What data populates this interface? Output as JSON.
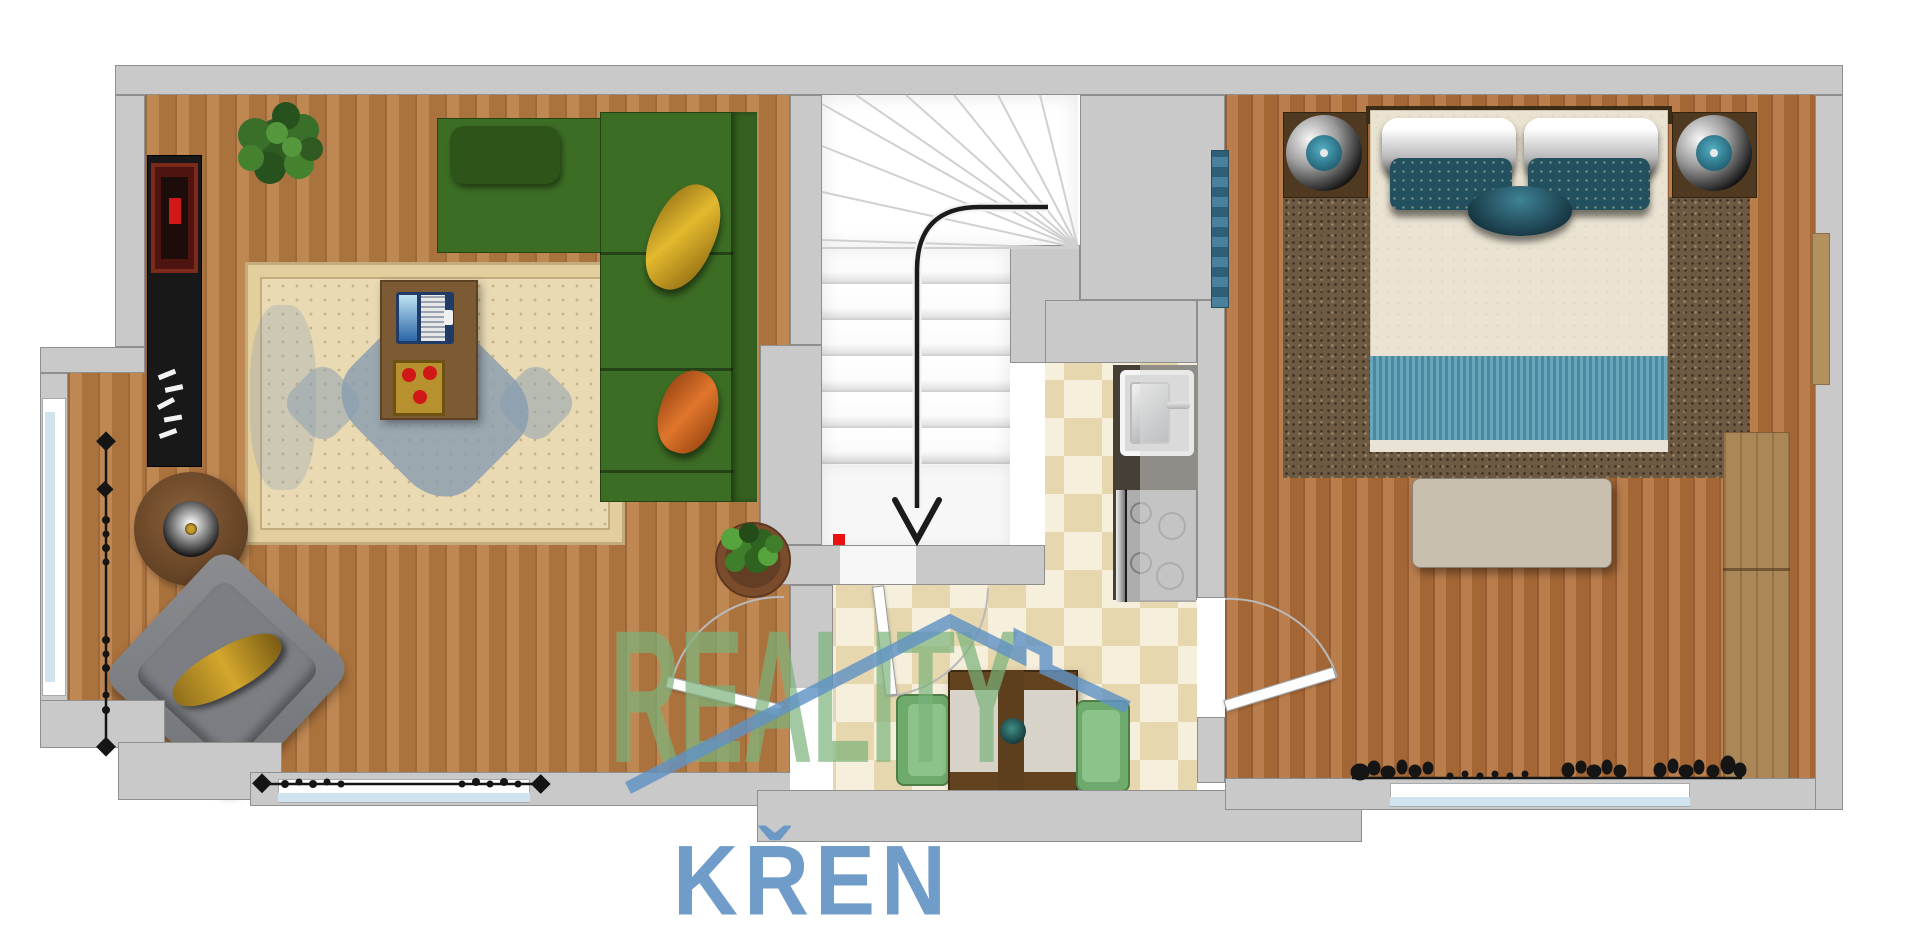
{
  "watermark": {
    "brand_line1": "REALITY",
    "brand_line2": "KŘEN",
    "house_icon_color": "#6092c4",
    "line1_color": "#7bb27b",
    "line2_color": "#6494c4"
  },
  "palette": {
    "wall": "#c9c9c9",
    "wall_edge": "#8f8f8f",
    "wood_living": "#b97c42",
    "wood_bedroom": "#b26f39",
    "tile_dark": "#e7d7ae",
    "tile_light": "#f6efdb",
    "sofa_green": "#3c6d24",
    "armchair_gray": "#83858a",
    "stair_arrow": "#1b1b1b",
    "alert_red": "#ea1111",
    "living_rug": "#e9dab4",
    "rug_medallion_blue": "#879bac",
    "bedroom_rug": "#6e5a42",
    "bed_linen": "#eae3d2",
    "pillow_teal": "#23505e",
    "bed_runner_blue": "#5e9cb1",
    "window_glass": "#cfe4ee"
  },
  "furniture_icons": [
    "media-console-icon",
    "potted-plant-icon",
    "sectional-sofa-icon",
    "oriental-rug-icon",
    "coffee-table-icon",
    "laptop-icon",
    "serving-tray-icon",
    "round-side-table-icon",
    "armchair-icon",
    "stair-run-arrow-icon",
    "kitchen-sink-icon",
    "cooktop-icon",
    "dining-table-icon",
    "dining-chair-icon",
    "double-bed-icon",
    "nightstand-lamp-icon",
    "bench-icon",
    "wardrobe-icon",
    "curtain-icon",
    "window-icon",
    "door-swing-icon"
  ]
}
